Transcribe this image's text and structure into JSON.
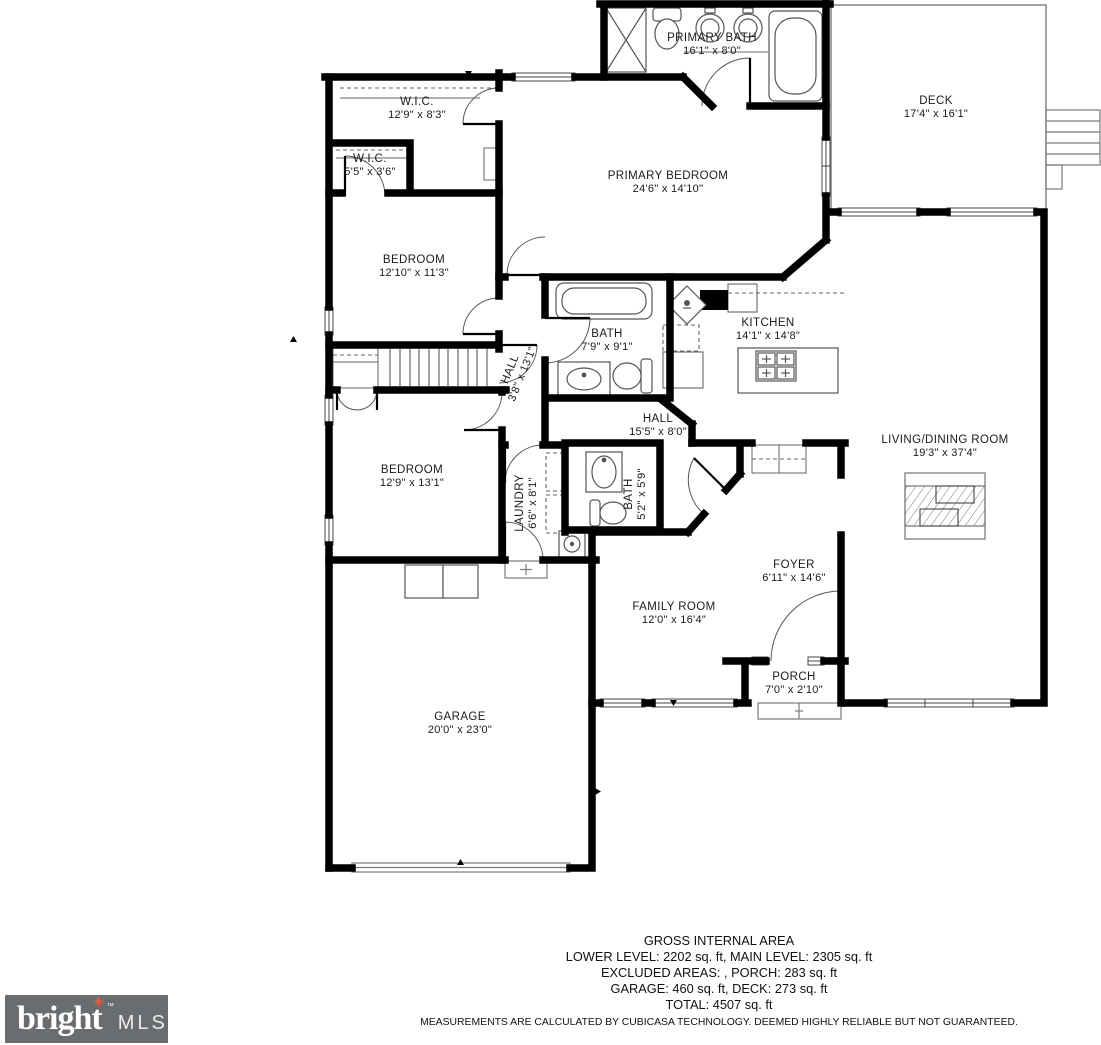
{
  "plan": {
    "rooms": [
      {
        "name": "PRIMARY BATH",
        "dims": "16'1\" x 8'0\""
      },
      {
        "name": "DECK",
        "dims": "17'4\" x 16'1\""
      },
      {
        "name": "W.I.C.",
        "dims": "12'9\" x 8'3\""
      },
      {
        "name": "W.I.C.",
        "dims": "5'5\" x 3'6\""
      },
      {
        "name": "PRIMARY BEDROOM",
        "dims": "24'6\" x 14'10\""
      },
      {
        "name": "BEDROOM",
        "dims": "12'10\" x 11'3\""
      },
      {
        "name": "BATH",
        "dims": "7'9\" x 9'1\""
      },
      {
        "name": "KITCHEN",
        "dims": "14'1\" x 14'8\""
      },
      {
        "name": "HALL",
        "dims": "3'8\" x 13'1\""
      },
      {
        "name": "HALL",
        "dims": "15'5\" x 8'0\""
      },
      {
        "name": "LIVING/DINING ROOM",
        "dims": "19'3\" x 37'4\""
      },
      {
        "name": "BEDROOM",
        "dims": "12'9\" x 13'1\""
      },
      {
        "name": "LAUNDRY",
        "dims": "6'6\" x 8'1\""
      },
      {
        "name": "BATH",
        "dims": "5'2\" x 5'9\""
      },
      {
        "name": "FOYER",
        "dims": "6'11\" x 14'6\""
      },
      {
        "name": "FAMILY ROOM",
        "dims": "12'0\" x 16'4\""
      },
      {
        "name": "PORCH",
        "dims": "7'0\" x 2'10\""
      },
      {
        "name": "GARAGE",
        "dims": "20'0\" x 23'0\""
      }
    ]
  },
  "footer": {
    "title": "GROSS INTERNAL AREA",
    "line1": "LOWER LEVEL: 2202 sq. ft, MAIN LEVEL: 2305 sq. ft",
    "line2": "EXCLUDED AREAS: , PORCH: 283 sq. ft",
    "line3": "GARAGE: 460 sq. ft, DECK: 273 sq. ft",
    "line4": "TOTAL: 4507 sq. ft",
    "disclaimer": "MEASUREMENTS ARE CALCULATED BY CUBICASA TECHNOLOGY. DEEMED HIGHLY RELIABLE BUT NOT GUARANTEED."
  },
  "logo": {
    "brand": "bright",
    "tm": "™",
    "suffix": "MLS"
  },
  "colors": {
    "wall": "#000000",
    "background": "#ffffff",
    "logo_background": "#6a6d6f",
    "logo_star": "#e05a3c"
  }
}
